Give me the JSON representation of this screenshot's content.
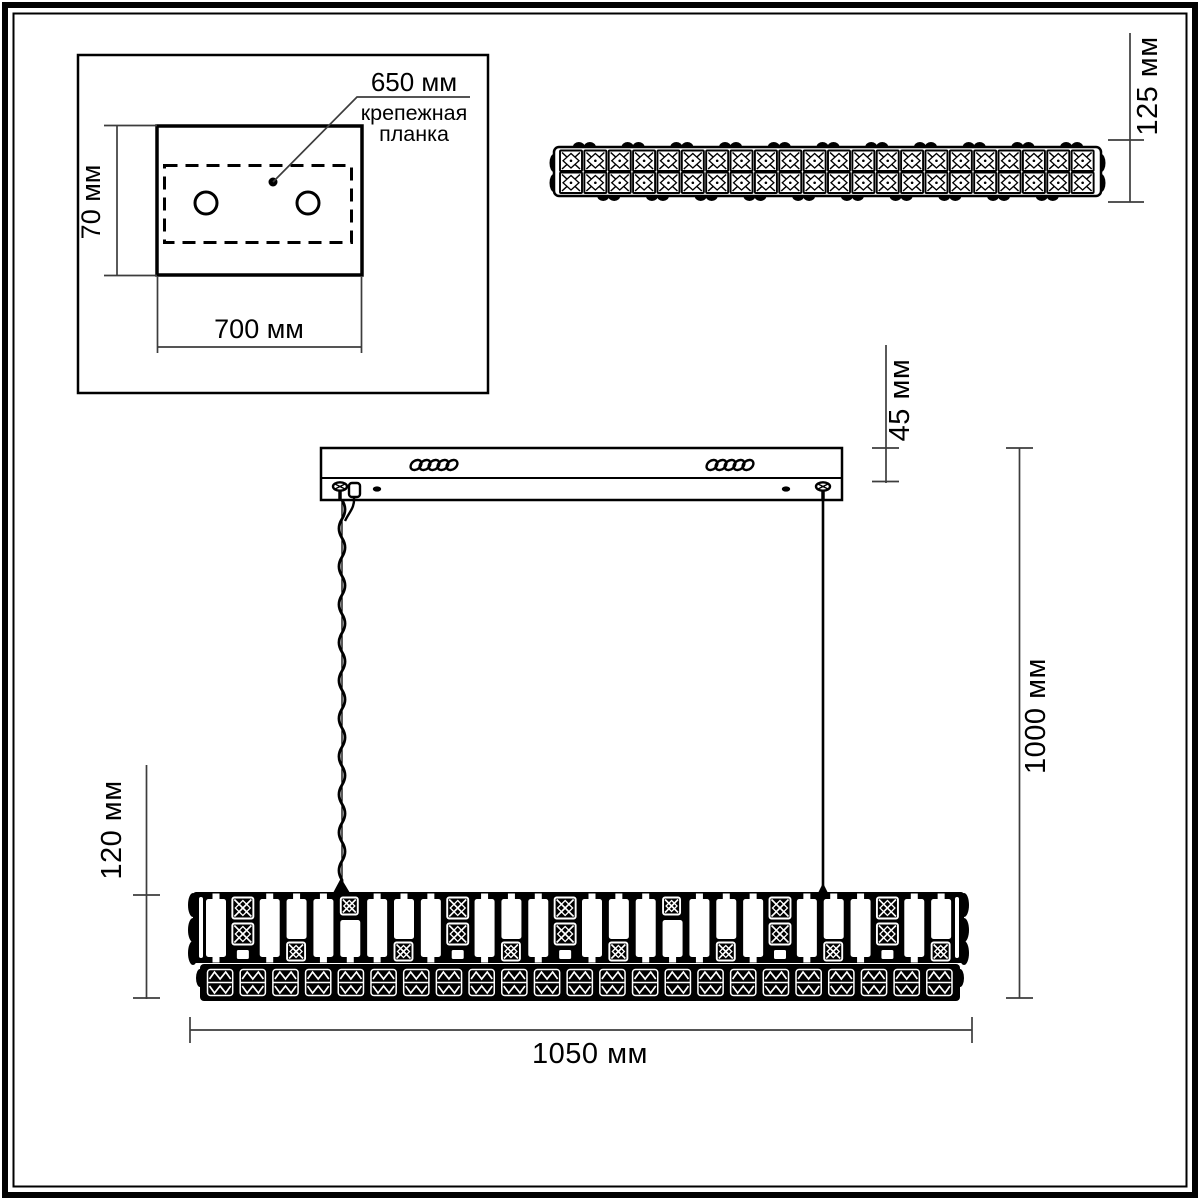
{
  "colors": {
    "ink": "#000000",
    "dim_line": "#3d3d3d",
    "background": "#ffffff"
  },
  "mounting_plate_panel": {
    "leader_label": "650 мм",
    "part_name_line1": "крепежная",
    "part_name_line2": "планка",
    "height_label": "70 мм",
    "width_label": "700 мм",
    "hole_count": 2
  },
  "side_view": {
    "height_label": "125 мм",
    "crystal_columns": 22,
    "crystal_rows": 2
  },
  "main_view": {
    "canopy_height_label": "45 мм",
    "suspension_height_label": "1000 мм",
    "fixture_height_label": "120 мм",
    "fixture_width_label": "1050 мм",
    "upper_band_columns": 28,
    "lower_band_cells": 23
  }
}
